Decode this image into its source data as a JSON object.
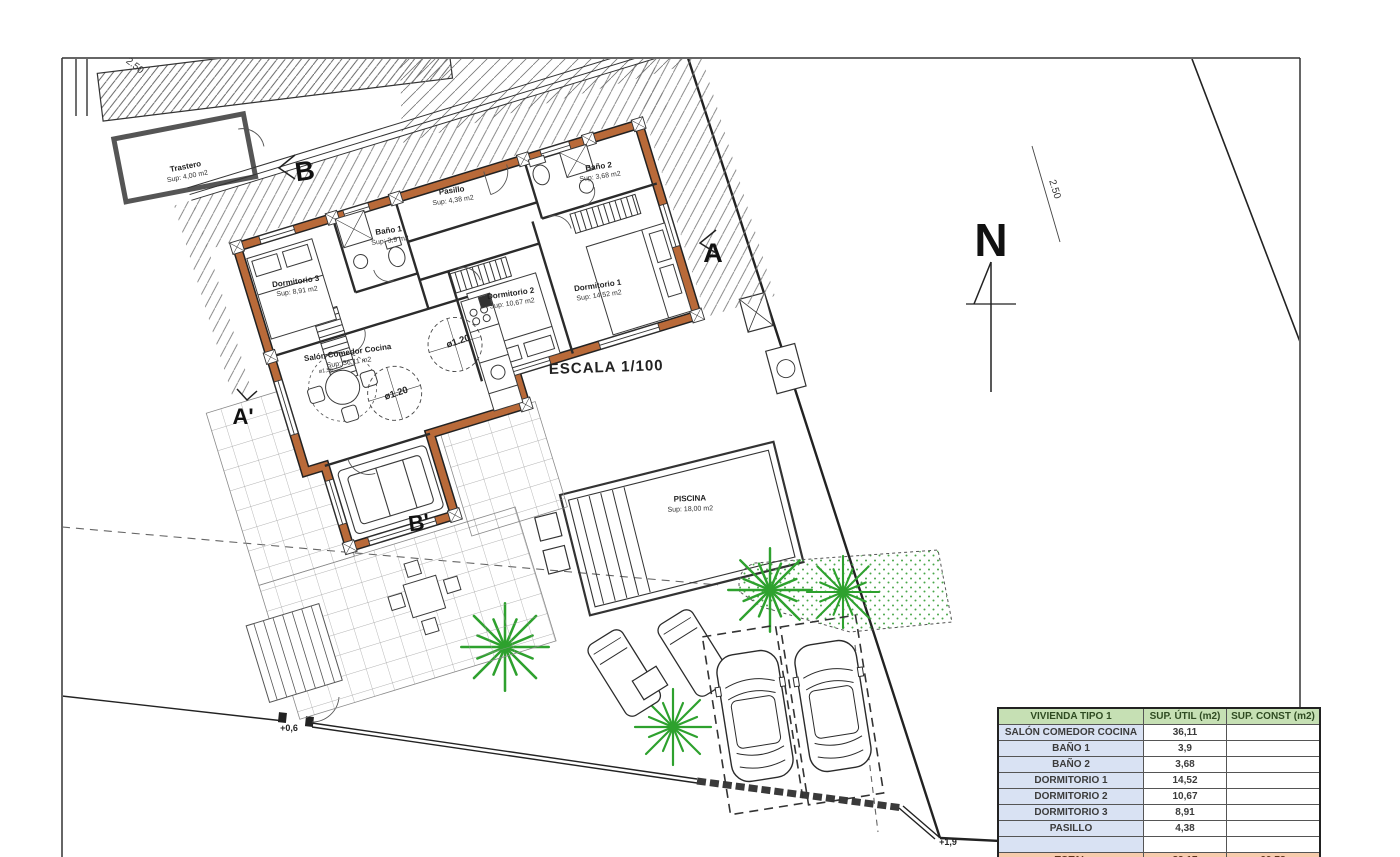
{
  "drawing": {
    "scale_label": "ESCALA 1/100",
    "north_label": "N",
    "rooms": [
      {
        "name": "Trastero",
        "area": "Sup: 4,00 m2"
      },
      {
        "name": "Pasillo",
        "area": "Sup: 4,38 m2"
      },
      {
        "name": "Baño 1",
        "area": "Sup: 3,9 m2"
      },
      {
        "name": "Baño 2",
        "area": "Sup: 3,68 m2"
      },
      {
        "name": "Dormitorio 3",
        "area": "Sup: 8,91 m2"
      },
      {
        "name": "Dormitorio 2",
        "area": "Sup: 10,67 m2"
      },
      {
        "name": "Dormitorio 1",
        "area": "Sup: 14,52 m2"
      },
      {
        "name": "Salón Comedor Cocina",
        "area": "Sup: 36,11 m2"
      },
      {
        "name": "PISCINA",
        "area": "Sup: 18,00 m2"
      }
    ],
    "sections": {
      "a": "A",
      "a_prime": "A'",
      "b": "B",
      "b_prime": "B'"
    },
    "annotations": {
      "circle_1": "ø1.20",
      "circle_2": "ø1.20",
      "table_diameter": "ø1,50",
      "dim_top_left": "2.50",
      "dim_right": "2.50",
      "level_gate": "+0,6",
      "level_corner": "+1,9"
    },
    "colors": {
      "wall_accent": "#b96a39",
      "vegetation": "#2ea12e",
      "table_header_bg": "#c6e0b4",
      "table_label_bg": "#d9e2f3",
      "table_total_bg": "#f7cbac"
    }
  },
  "area_table": {
    "header": [
      "VIVIENDA TIPO 1",
      "SUP. ÚTIL (m2)",
      "SUP. CONST (m2)"
    ],
    "rows": [
      [
        "SALÓN COMEDOR COCINA",
        "36,11",
        ""
      ],
      [
        "BAÑO 1",
        "3,9",
        ""
      ],
      [
        "BAÑO 2",
        "3,68",
        ""
      ],
      [
        "DORMITORIO 1",
        "14,52",
        ""
      ],
      [
        "DORMITORIO 2",
        "10,67",
        ""
      ],
      [
        "DORMITORIO 3",
        "8,91",
        ""
      ],
      [
        "PASILLO",
        "4,38",
        ""
      ],
      [
        "",
        "",
        ""
      ],
      [
        "TOTAL",
        "82,17",
        "99,78"
      ]
    ]
  }
}
